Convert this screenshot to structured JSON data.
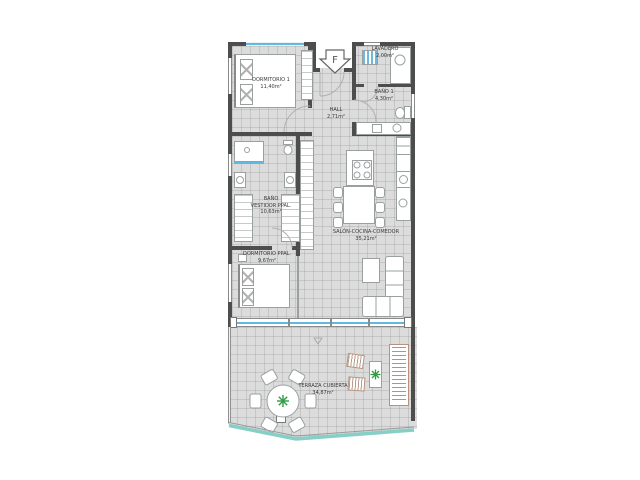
{
  "plan": {
    "entrance_marker": "F",
    "rooms": [
      {
        "id": "dormitorio-1",
        "name": "DORMITORIO 1",
        "area": "11,40m²"
      },
      {
        "id": "lavadero",
        "name": "LAVADERO",
        "area": "2,00m²"
      },
      {
        "id": "bano-1",
        "name": "BAÑO 1",
        "area": "4,30m²"
      },
      {
        "id": "hall",
        "name": "HALL",
        "area": "2,71m²"
      },
      {
        "id": "bano-vestidor-ppal",
        "name": "BAÑO\nVESTIDOR PPAL.",
        "area": "10,63m²"
      },
      {
        "id": "dormitorio-ppal",
        "name": "DORMITORIO PPAL.",
        "area": "9,67m²"
      },
      {
        "id": "salon-cocina-comedor",
        "name": "SALÓN-COCINA-COMEDOR",
        "area": "35,21m²"
      },
      {
        "id": "terraza-cubierta",
        "name": "TERRAZA CUBIERTA",
        "area": "34,87m²"
      }
    ],
    "colors": {
      "wall": "#4d4d4d",
      "floor": "#dcdcdd",
      "glass": "#62b8e0",
      "balustrade": "#86cfc7",
      "plant": "#2e9e44",
      "furniture_stroke": "#9aa0a0",
      "wood_frame": "#b5917e"
    }
  }
}
